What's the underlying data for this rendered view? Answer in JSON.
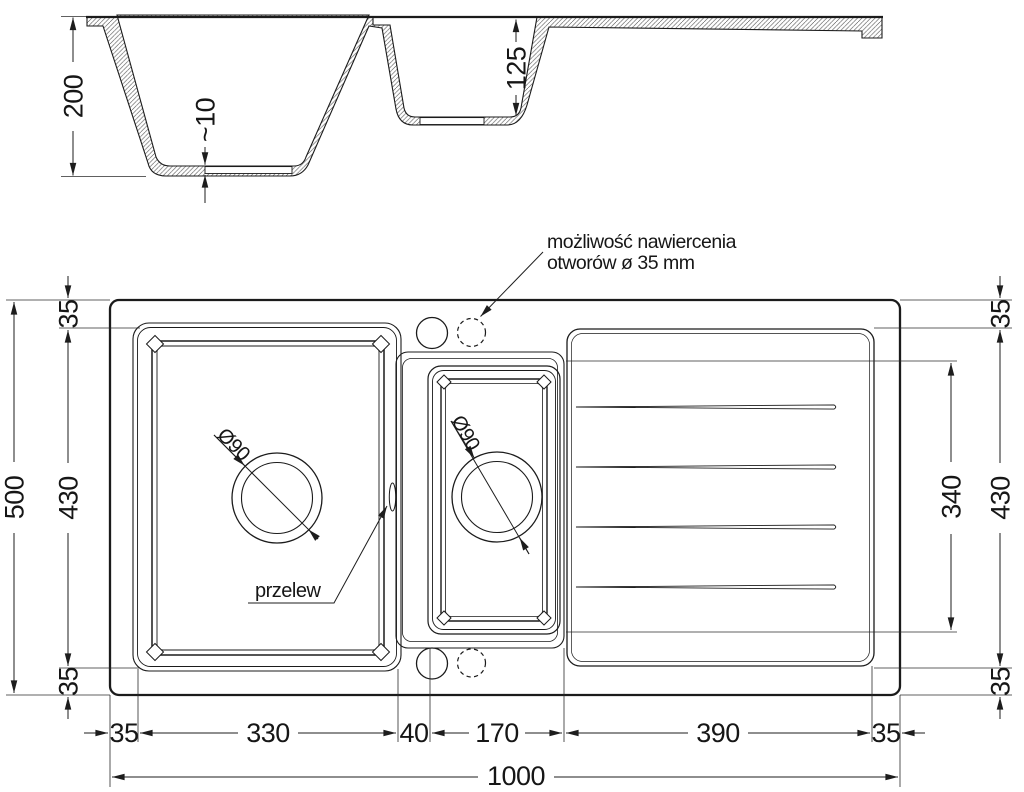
{
  "section_view": {
    "dim_depth_main": "200",
    "dim_bottom_thickness": "~10",
    "dim_depth_small": "125"
  },
  "plan_view": {
    "note_drill_line1": "możliwość nawiercenia",
    "note_drill_line2": "otworów ø 35 mm",
    "label_overflow": "przelew",
    "label_drain_main": "Ø90",
    "label_drain_small": "Ø90",
    "left_dims": {
      "margin_top": "35",
      "basin_height": "430",
      "margin_bottom": "35",
      "total_height": "500"
    },
    "right_dims": {
      "margin_top": "35",
      "drainer_height": "430",
      "margin_bottom": "35",
      "grooves_height": "340"
    },
    "bottom_dims": {
      "segments": [
        "35",
        "330",
        "40",
        "170",
        "390",
        "35"
      ],
      "total_width": "1000"
    }
  },
  "colors": {
    "line": "#1b1b1b",
    "dim_line": "#1d1d1d",
    "background": "#ffffff"
  }
}
